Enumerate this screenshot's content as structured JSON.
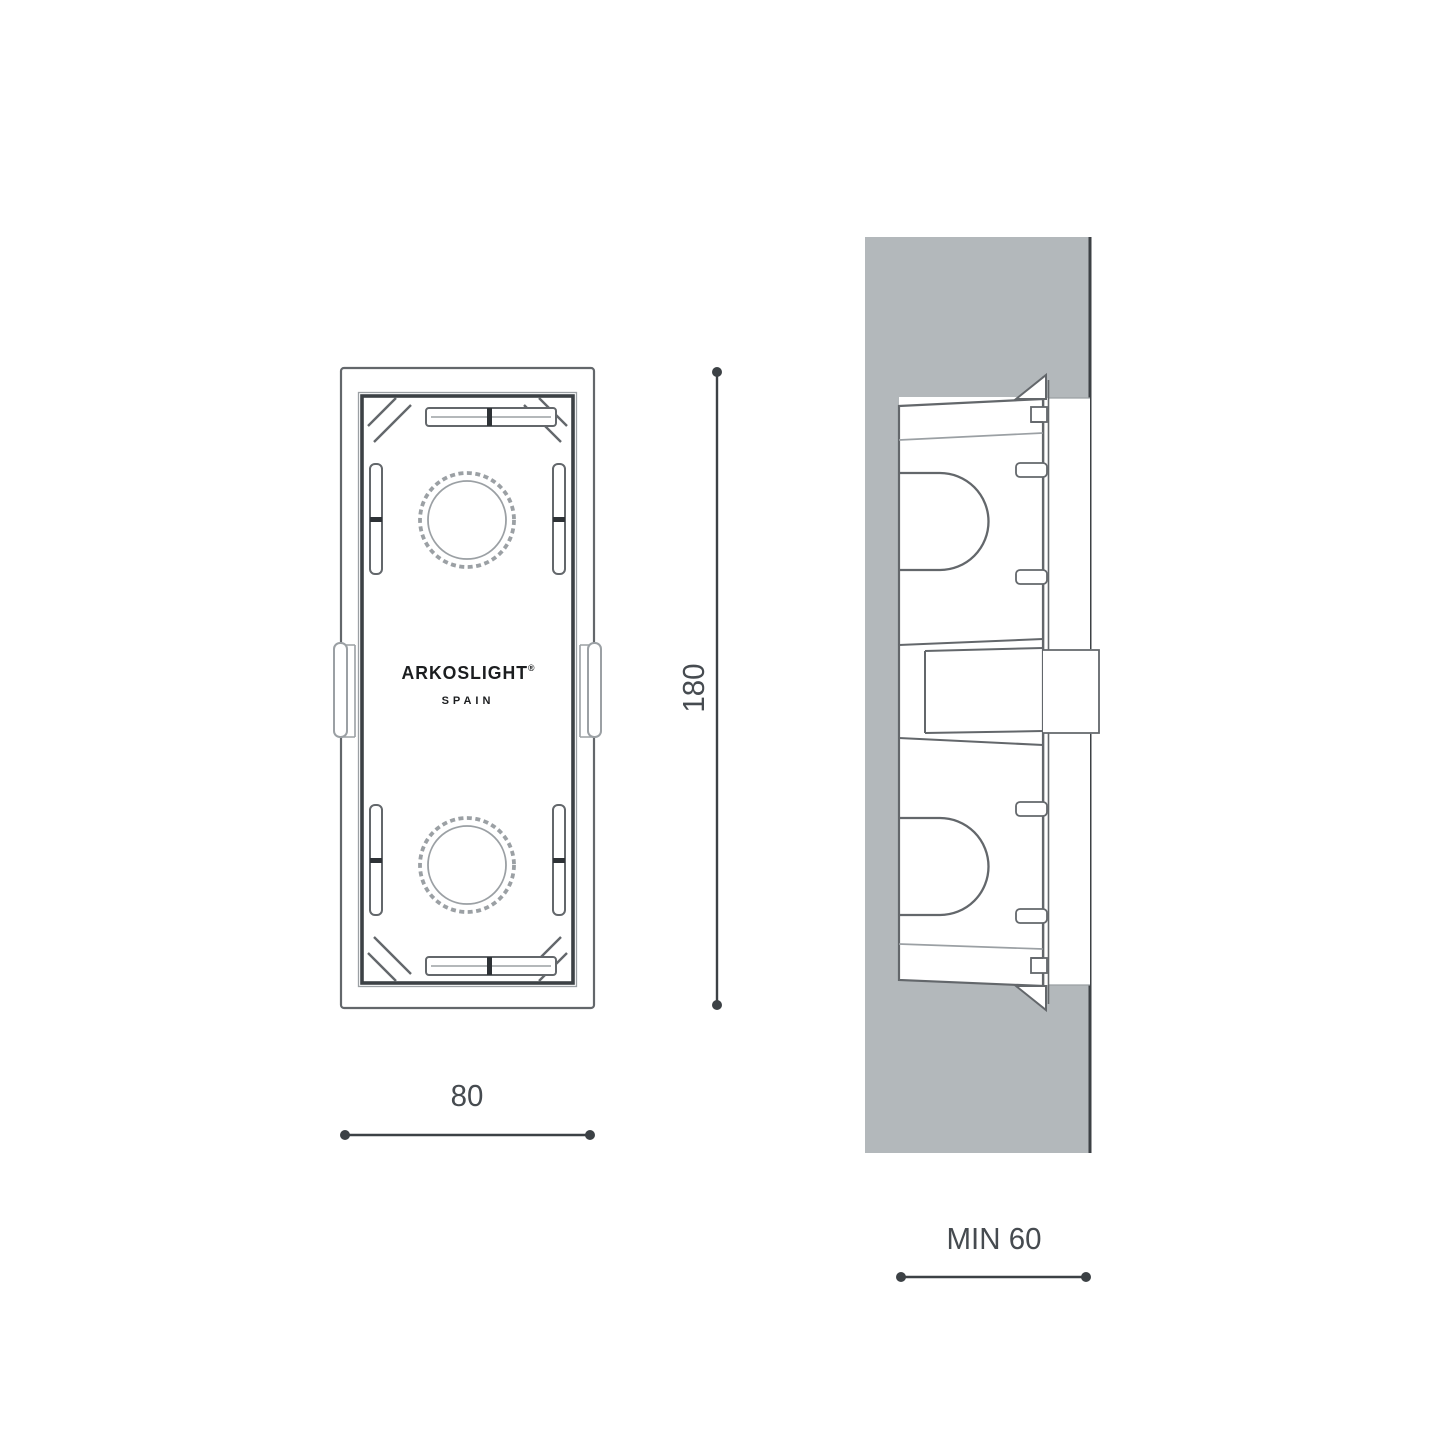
{
  "page": {
    "background": "#ffffff",
    "description": "Technical installation drawing of a recessed mounting box: front view with width/height dimensions and wall-section side view with minimum recess depth"
  },
  "colors": {
    "wall_gray": "#b3b8bb",
    "line_dark": "#3c4145",
    "line_med": "#63676b",
    "line_light": "#9ba0a4",
    "tick_dark": "#2e3236",
    "text": "#464b50",
    "logo": "#1b1d1f"
  },
  "front_view": {
    "logo_brand": "ARKOSLIGHT",
    "logo_registered": "®",
    "logo_country": "SPAIN",
    "width_dimension": {
      "label": "80"
    },
    "height_dimension": {
      "label": "180"
    }
  },
  "side_view": {
    "depth_dimension": {
      "label": "MIN 60"
    }
  }
}
